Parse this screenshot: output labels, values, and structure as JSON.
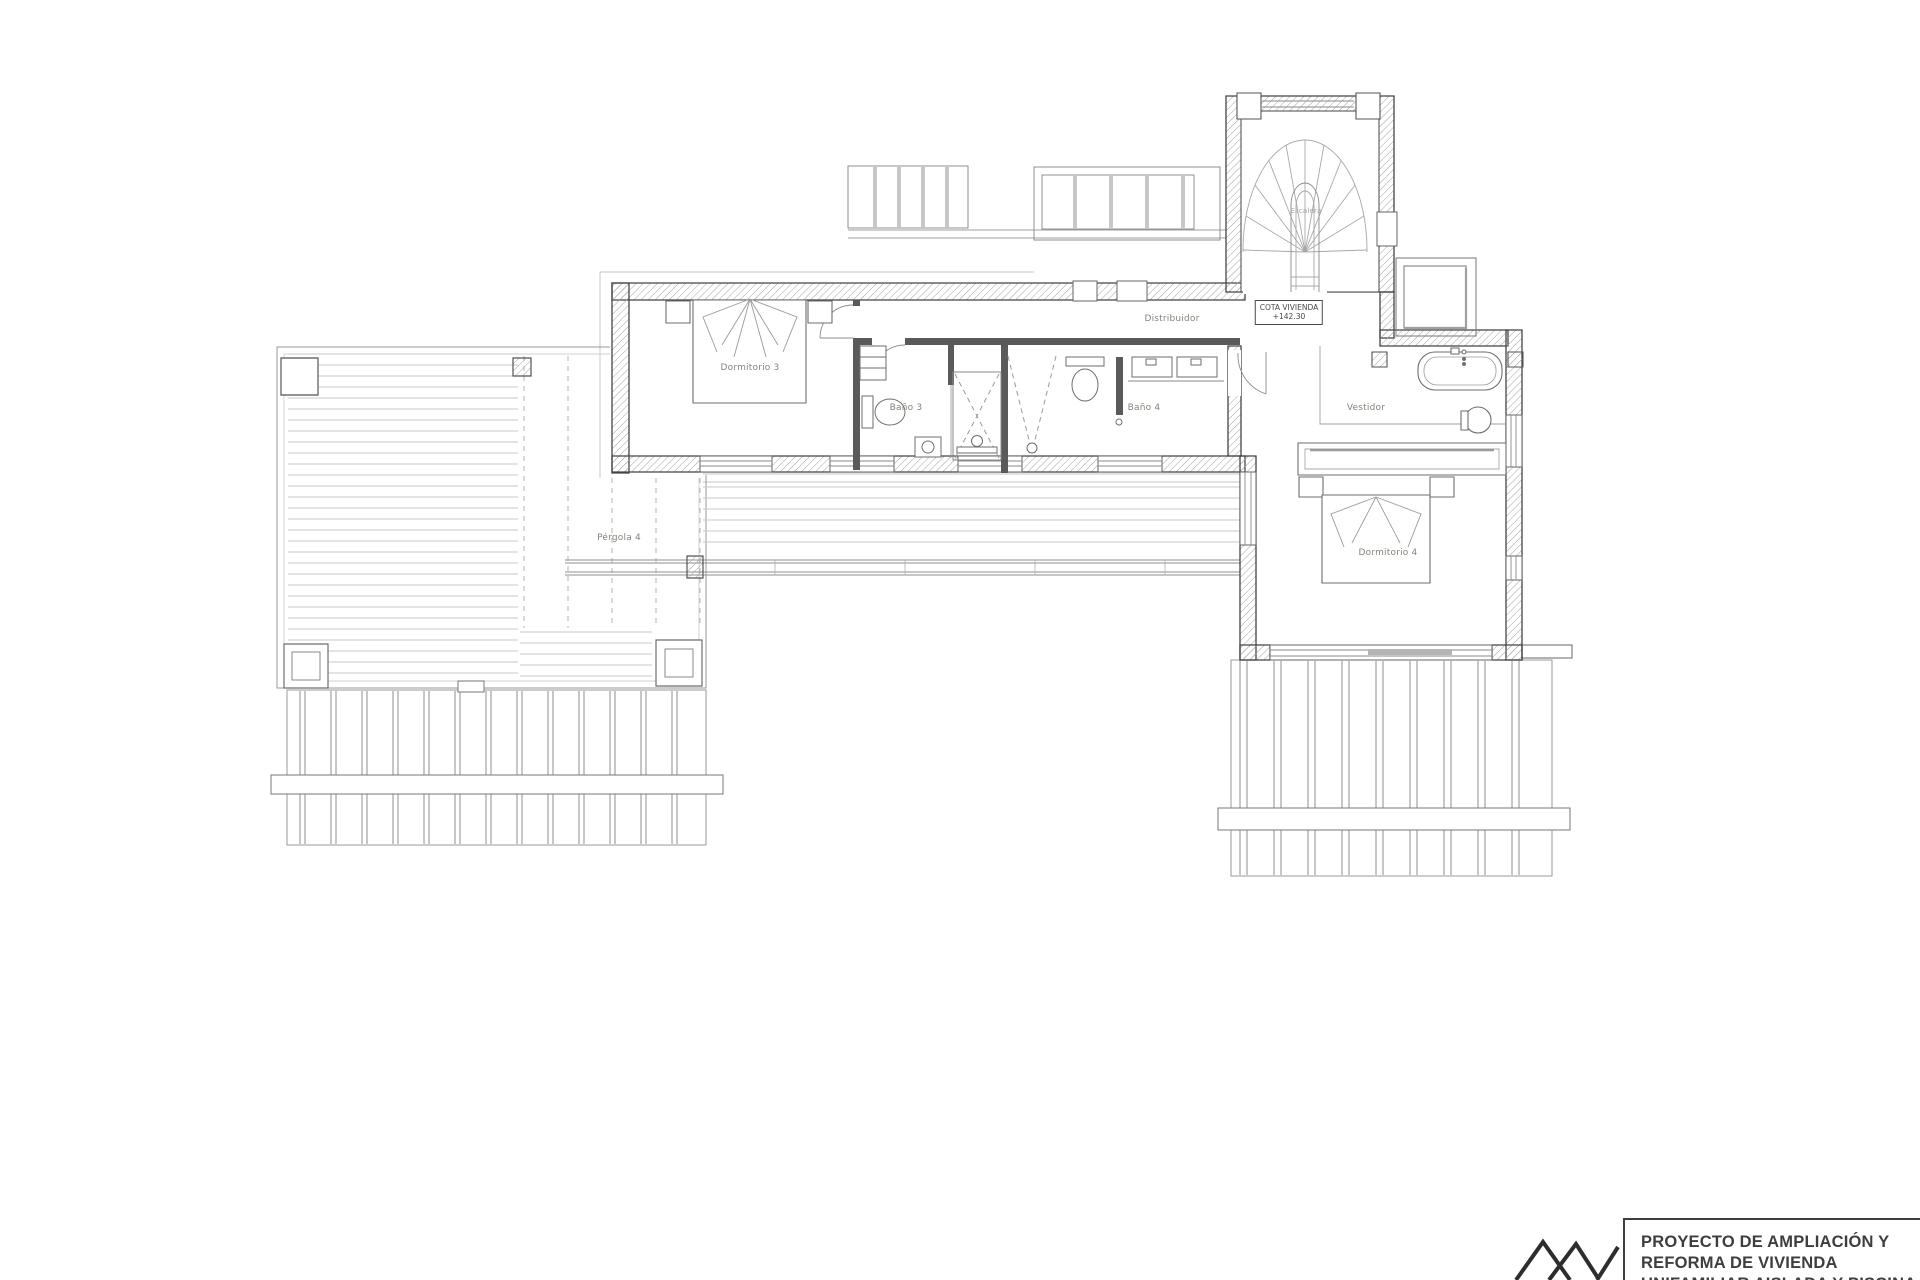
{
  "plan": {
    "rooms": [
      {
        "id": "dormitorio3",
        "label": "Dormitorio 3"
      },
      {
        "id": "bano3",
        "label": "Baño 3"
      },
      {
        "id": "bano4",
        "label": "Baño 4"
      },
      {
        "id": "distribuidor",
        "label": "Distribuidor"
      },
      {
        "id": "escalera",
        "label": "Escalera"
      },
      {
        "id": "vestidor",
        "label": "Vestidor"
      },
      {
        "id": "dormitorio4",
        "label": "Dormitorio 4"
      },
      {
        "id": "pergola4",
        "label": "Pérgola 4"
      }
    ],
    "cota_box": {
      "line1": "COTA VIVIENDA",
      "line2": "+142.30"
    }
  },
  "title_block": {
    "line1": "PROYECTO DE AMPLIACIÓN Y",
    "line2": "REFORMA DE VIVIENDA",
    "line3": "UNIFAMILIAR AISLADA Y PISCINA"
  },
  "colors": {
    "ink": "#3e3e3e",
    "wall_hatch": "#a3a3a3",
    "light_line": "#c9c9c9",
    "label": "#87837a"
  }
}
